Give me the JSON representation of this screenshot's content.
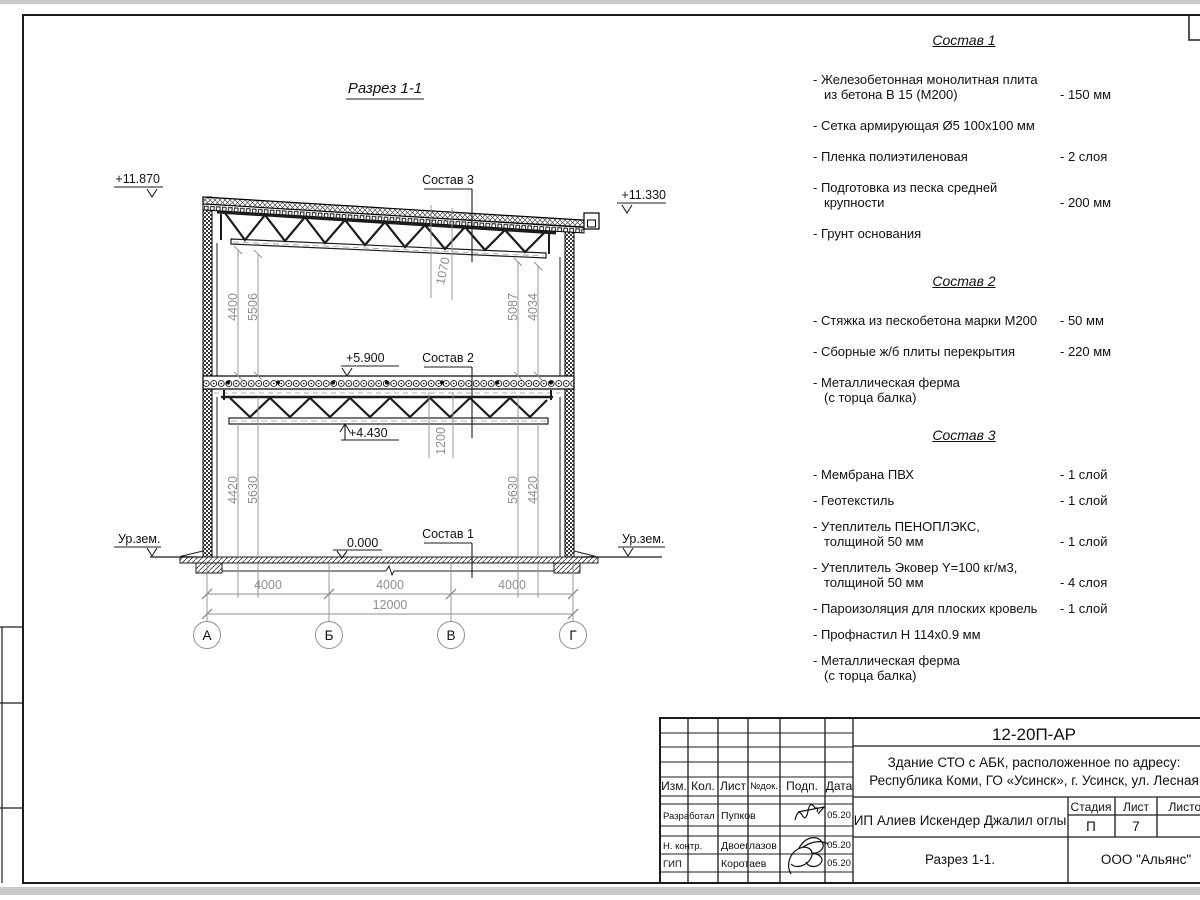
{
  "page": {
    "drawing_title": "Разрез 1-1",
    "colors": {
      "line": "#1c1c1c",
      "dim": "#8f8f8f",
      "paper": "#ffffff",
      "scan_edge": "#c9c9c9"
    }
  },
  "section": {
    "labels": {
      "sostav1": "Состав 1",
      "sostav2": "Состав 2",
      "sostav3": "Состав 3"
    },
    "elevations": {
      "roof_left": "+11.870",
      "roof_right": "+11.330",
      "floor2": "+5.900",
      "truss_bottom": "+4.430",
      "zero": "0.000",
      "ground_left": "Ур.зем.",
      "ground_right": "Ур.зем."
    },
    "dims": {
      "upper_left_outer": "4400",
      "upper_left_inner": "5506",
      "upper_mid": "1070",
      "upper_right_inner": "5087",
      "upper_right_outer": "4034",
      "lower_left_outer": "4420",
      "lower_left_inner": "5630",
      "lower_mid": "1200",
      "lower_right_inner": "5630",
      "lower_right_outer": "4420",
      "span1": "4000",
      "span2": "4000",
      "span3": "4000",
      "total": "12000"
    },
    "axes": {
      "a": "А",
      "b": "Б",
      "v": "В",
      "g": "Г"
    }
  },
  "compositions": [
    {
      "heading": "Состав 1",
      "items": [
        {
          "line1": "- Железобетонная  монолитная плита",
          "line2": "из бетона В 15 (М200)",
          "value": "- 150 мм"
        },
        {
          "line1": "- Сетка армирующая Ø5 100х100 мм",
          "line2": "",
          "value": ""
        },
        {
          "line1": "- Пленка полиэтиленовая",
          "line2": "",
          "value": "-  2 слоя"
        },
        {
          "line1": "- Подготовка из песка средней",
          "line2": "крупности",
          "value": "- 200 мм"
        },
        {
          "line1": "- Грунт основания",
          "line2": "",
          "value": ""
        }
      ]
    },
    {
      "heading": "Состав 2",
      "items": [
        {
          "line1": "- Стяжка из пескобетона марки М200",
          "line2": "",
          "value": "- 50 мм"
        },
        {
          "line1": "- Сборные ж/б плиты перекрытия",
          "line2": "",
          "value": "- 220 мм"
        },
        {
          "line1": "- Металлическая ферма",
          "line2": "(с торца балка)",
          "value": ""
        }
      ]
    },
    {
      "heading": "Состав 3",
      "items": [
        {
          "line1": "- Мембрана ПВХ",
          "line2": "",
          "value": "- 1 слой"
        },
        {
          "line1": "- Геотекстиль",
          "line2": "",
          "value": "- 1 слой"
        },
        {
          "line1": "- Утеплитель ПЕНОПЛЭКС,",
          "line2": "толщиной 50 мм",
          "value": "- 1 слой"
        },
        {
          "line1": "- Утеплитель Эковер Y=100 кг/м3,",
          "line2": "толщиной 50 мм",
          "value": "- 4 слоя"
        },
        {
          "line1": "- Пароизоляция для плоских кровель",
          "line2": "",
          "value": "- 1 слой"
        },
        {
          "line1": "- Профнастил Н 114х0.9 мм",
          "line2": "",
          "value": ""
        },
        {
          "line1": "- Металлическая ферма",
          "line2": "(с торца балка)",
          "value": ""
        }
      ]
    }
  ],
  "title_block": {
    "doc_number": "12-20П-АР",
    "object_line1": "Здание СТО с АБК, расположенное по адресу:",
    "object_line2": "Республика Коми, ГО «Усинск», г. Усинск, ул. Лесная",
    "client": "ИП Алиев Искендер Джалил оглы",
    "sheet_title": "Разрез 1-1.",
    "company": "ООО \"Альянс\"",
    "stage_label": "Стадия",
    "sheet_label": "Лист",
    "sheets_label": "Листов",
    "stage_value": "П",
    "sheet_value": "7",
    "columns": {
      "izm": "Изм.",
      "kol": "Кол.",
      "list": "Лист",
      "ndok": "№док.",
      "podp": "Подп.",
      "data": "Дата"
    },
    "rows": [
      {
        "role": "Разработал",
        "name": "Пупков",
        "date": "05.20"
      },
      {
        "role": "Н. контр.",
        "name": "Двоеглазов",
        "date": "05.20"
      },
      {
        "role": "ГИП",
        "name": "Коротаев",
        "date": "05.20"
      }
    ]
  }
}
